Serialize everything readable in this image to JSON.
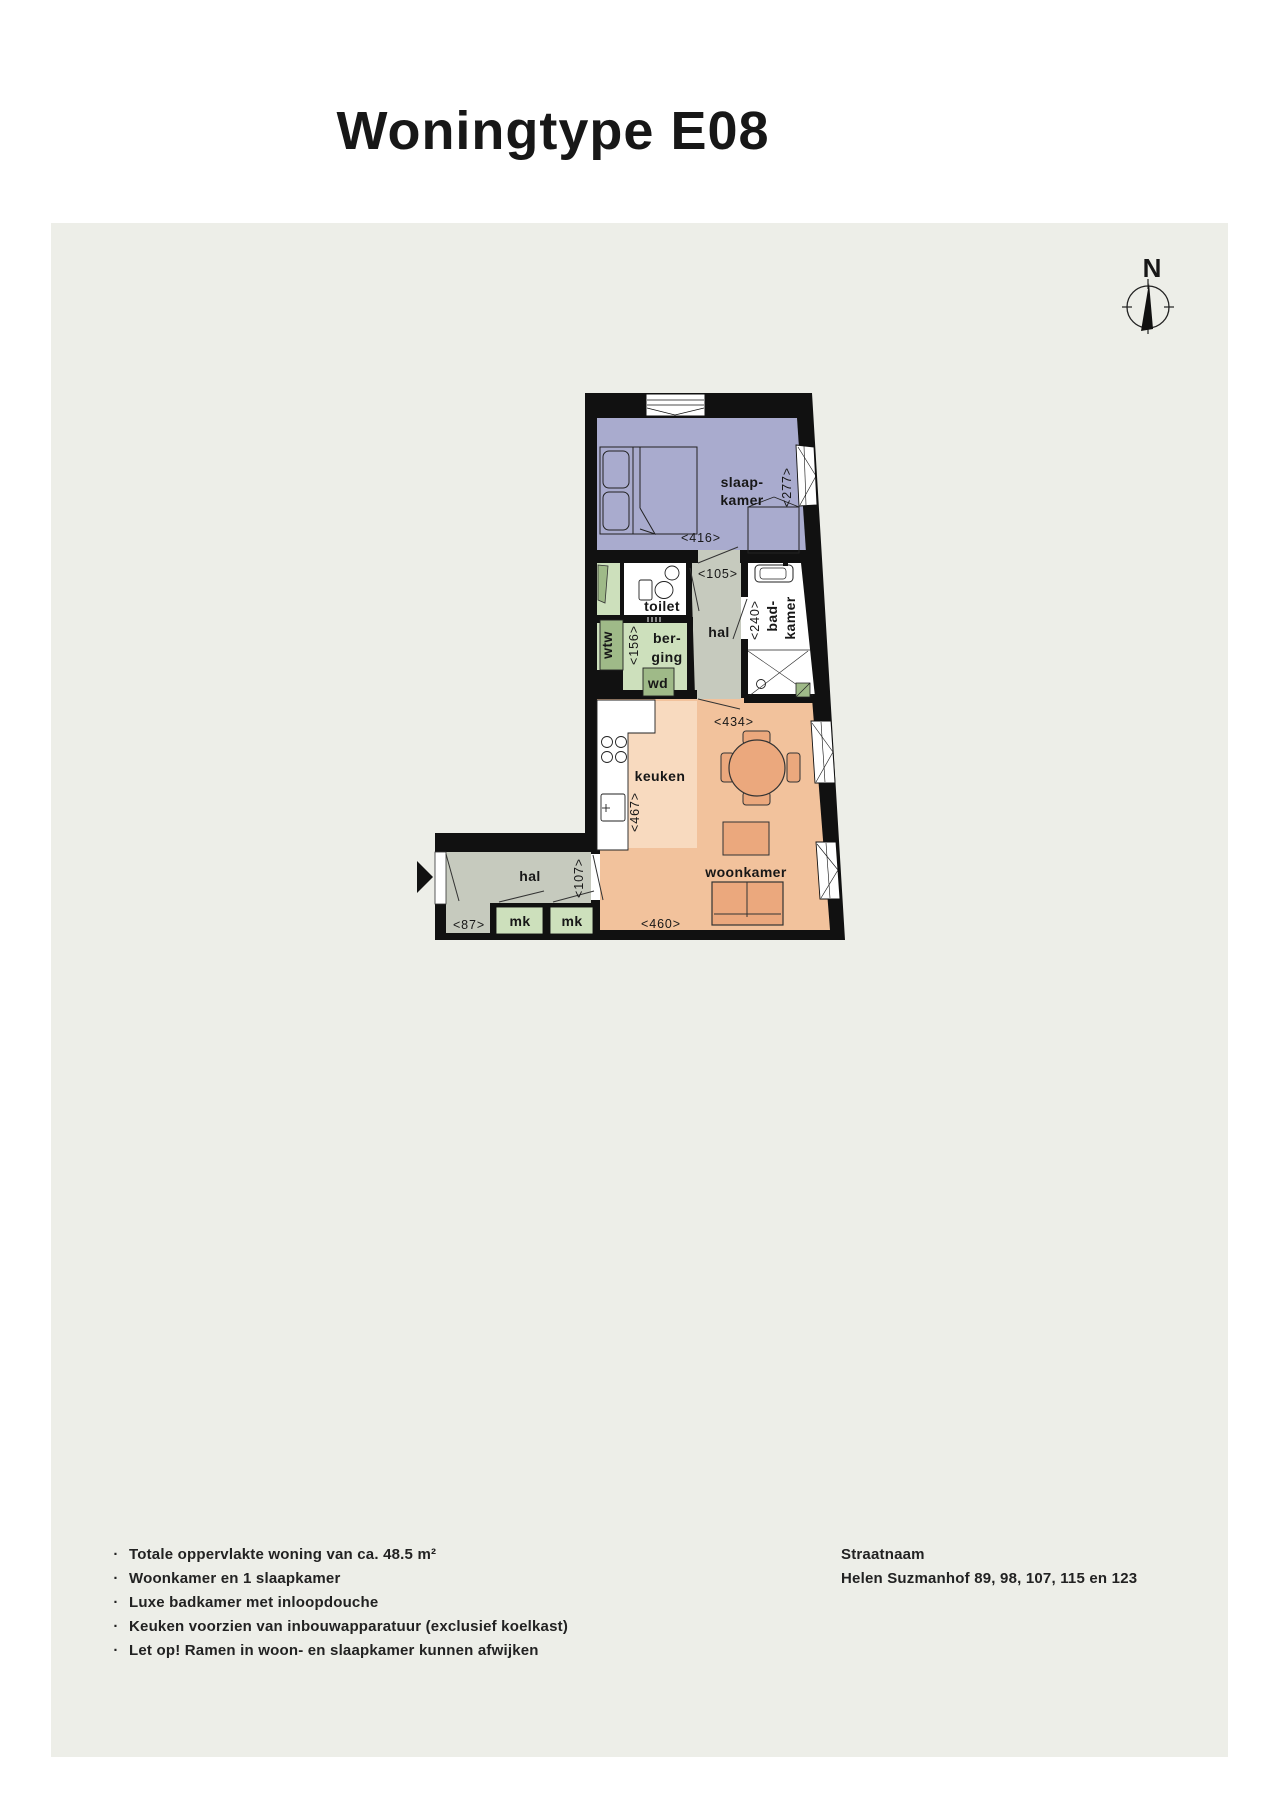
{
  "title": "Woningtype E08",
  "compass": {
    "n": "N"
  },
  "colors": {
    "panel": "#edeee8",
    "wall": "#111111",
    "slaapkamer": "#a9abce",
    "keuken_licht": "#f8dabf",
    "woonkamer": "#f2c29c",
    "hal": "#c6cabe",
    "groen_licht": "#cde0bc",
    "groen_donker": "#9fba88",
    "meubel": "#eba87d"
  },
  "plan": {
    "slaapkamer": {
      "line1": "slaap-",
      "line2": "kamer",
      "width": "<416>",
      "depth": "<277>"
    },
    "toilet": {
      "label": "toilet"
    },
    "hal_midden": {
      "label": "hal",
      "width": "<105>"
    },
    "badkamer": {
      "line1": "bad-",
      "line2": "kamer",
      "depth": "<240>"
    },
    "berging": {
      "line1": "ber-",
      "line2": "ging",
      "depth": "<156>"
    },
    "wtw": {
      "label": "wtw"
    },
    "wd": {
      "label": "wd"
    },
    "keuken": {
      "label": "keuken",
      "depth": "<467>"
    },
    "woonkamer": {
      "label": "woonkamer",
      "width": "<460>",
      "width_top": "<434>"
    },
    "hal_entree": {
      "label": "hal",
      "width": "<87>",
      "depth": "<107>"
    },
    "mk": {
      "label": "mk"
    }
  },
  "footer": {
    "bullet_glyph": "·",
    "bullets": [
      "Totale oppervlakte woning van ca. 48.5 m²",
      "Woonkamer en 1 slaapkamer",
      "Luxe badkamer met inloopdouche",
      "Keuken voorzien van inbouwapparatuur (exclusief koelkast)",
      "Let op! Ramen in woon- en slaapkamer kunnen afwijken"
    ],
    "address": {
      "heading": "Straatnaam",
      "line": "Helen Suzmanhof 89, 98, 107, 115 en 123"
    }
  }
}
